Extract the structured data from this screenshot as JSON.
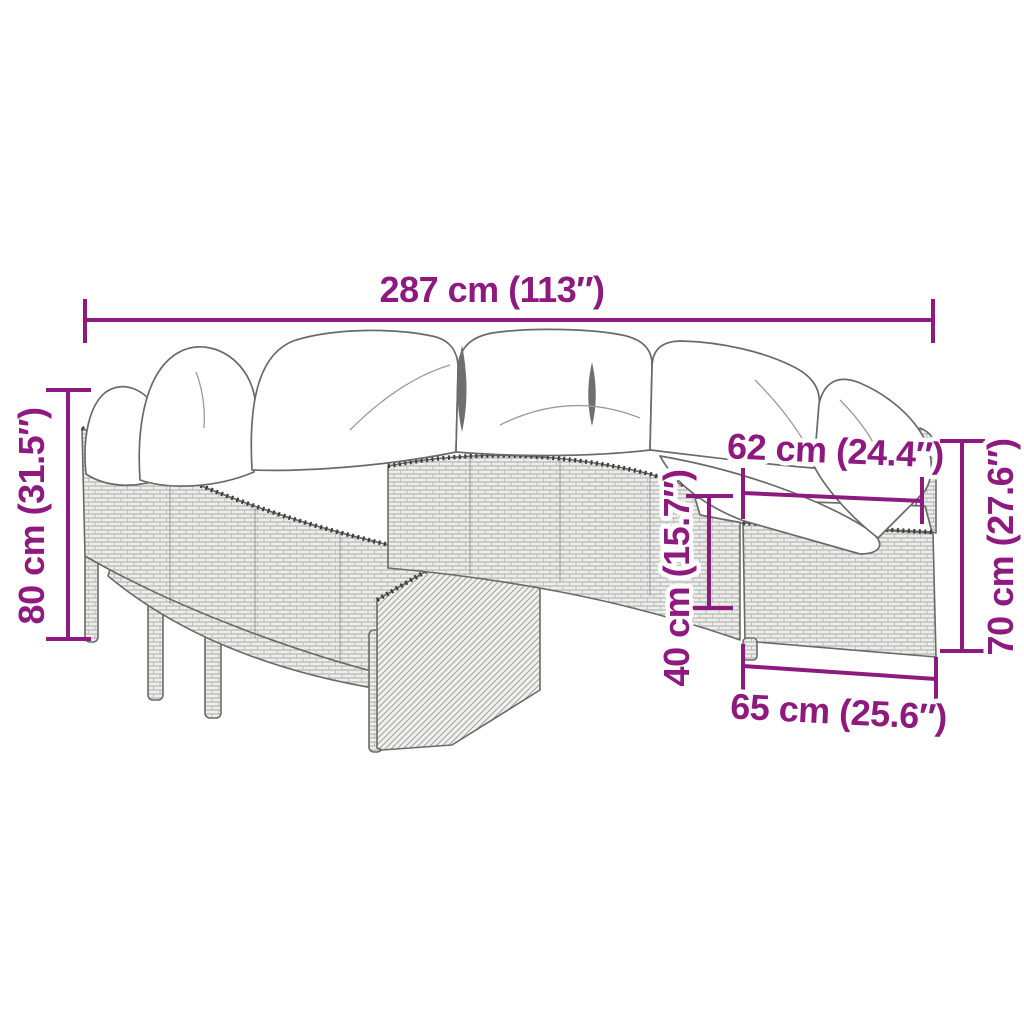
{
  "meta": {
    "title": "Round poly rattan garden sofa set with cushions — dimension diagram"
  },
  "colors": {
    "dimension": "#8e1a80",
    "outline": "#6a6a68",
    "rattan_fill": "#eeeeec",
    "rattan_line": "#a8a8a6",
    "cushion": "#ffffff"
  },
  "dimensions": {
    "total_width": {
      "label": "287 cm (113″)"
    },
    "total_height": {
      "label": "80 cm (31.5″)"
    },
    "seat_width": {
      "label": "62 cm (24.4″)"
    },
    "seat_height": {
      "label": "40 cm (15.7″)"
    },
    "module_height": {
      "label": "70 cm (27.6″)"
    },
    "module_depth": {
      "label": "65 cm (25.6″)"
    }
  }
}
